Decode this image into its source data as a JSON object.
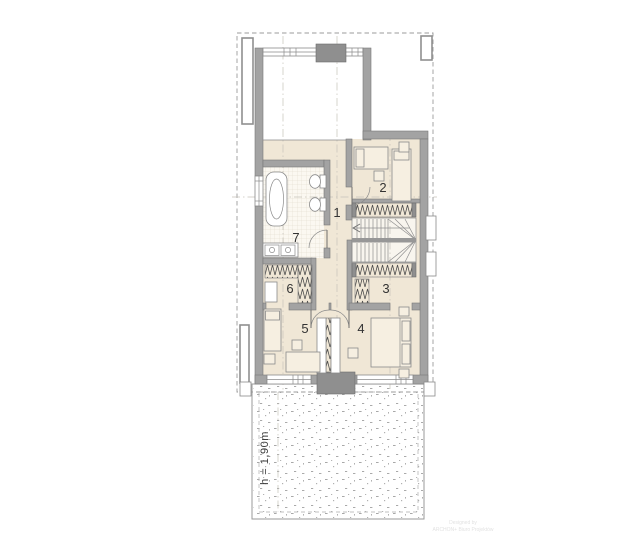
{
  "floor_plan": {
    "room_labels": {
      "hall": "1",
      "bedroom_top": "2",
      "closet_right": "3",
      "bedroom_right": "4",
      "bedroom_left": "5",
      "closet_left": "6",
      "bathroom": "7"
    },
    "terrace_annotation": "h = 1,90m",
    "watermark": {
      "line1": "Designed by",
      "line2": "ARCHON+ Biuro Projektów"
    },
    "colors": {
      "floor": "#f0e7d6",
      "wall": "#a3a3a3",
      "wall_outline": "#787878",
      "accent_dark": "#8f8f8f",
      "dash": "#9b9b9b",
      "label": "#333333"
    }
  }
}
